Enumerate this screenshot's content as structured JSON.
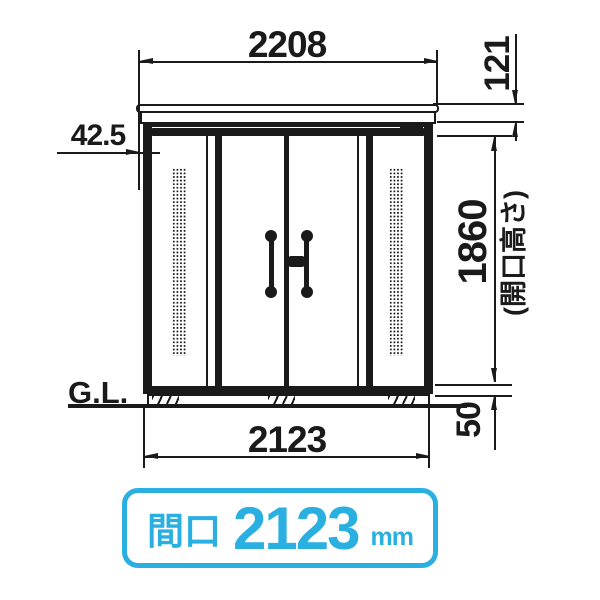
{
  "drawing": {
    "title_implicit": "storage shed front elevation",
    "dim_top_width": "2208",
    "dim_roof_height": "121",
    "dim_eave_offset": "42.5",
    "dim_opening_height": "1860",
    "dim_opening_height_note": "(開口高さ)",
    "ground_line_label": "G.L.",
    "dim_body_width": "2123",
    "dim_base_height": "50"
  },
  "badge": {
    "label": "間口",
    "value": "2123",
    "unit": "mm",
    "accent_color": "#29b0e0"
  },
  "colors": {
    "line": "#1a1a1a",
    "background": "#ffffff"
  }
}
